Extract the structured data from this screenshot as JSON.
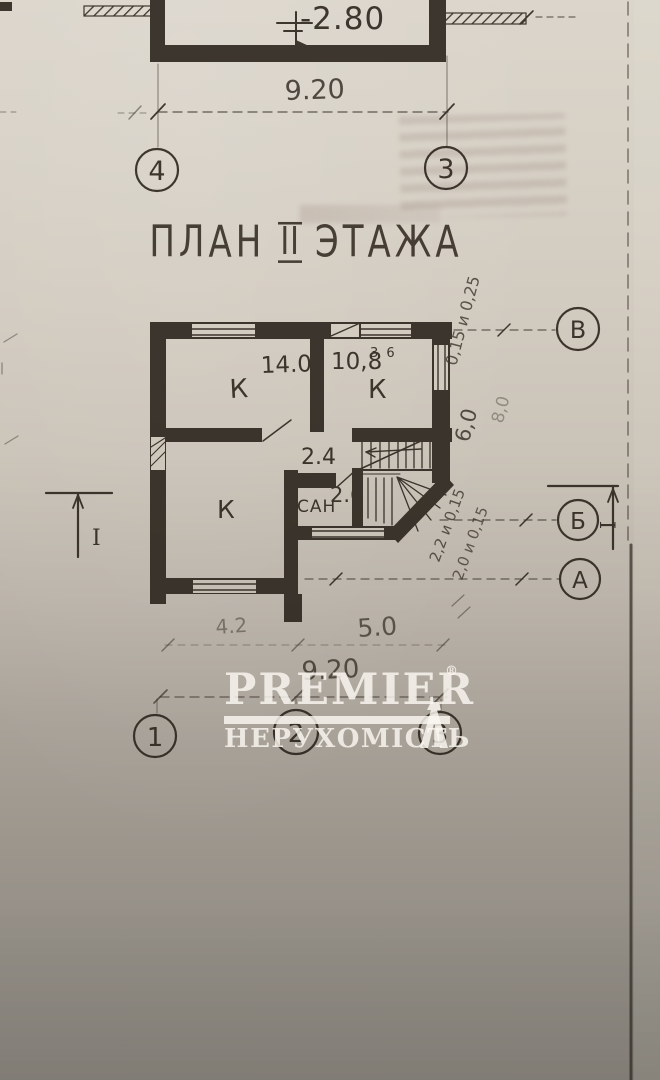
{
  "colors": {
    "ink": "#2b241c",
    "watermark_white": "#fbf8f2"
  },
  "title": {
    "word1": "ПЛАН",
    "numeral": "II",
    "word2": "ЭТАЖА"
  },
  "upper_plan": {
    "level_mark": "-2.80",
    "width_dim": "9.20",
    "axis_left": "4",
    "axis_right": "3"
  },
  "plan": {
    "room_tl_label": "К",
    "room_tl_area": "14.0",
    "room_tr_label": "К",
    "room_tr_area": "10,8",
    "room_tr_area_sup": "3 6",
    "room_bl_label": "К",
    "hall_area": "2.4",
    "san_label": "САН",
    "san_area": "2.6"
  },
  "dims_bottom": {
    "left": "4.2",
    "right": "5.0",
    "total": "9.20"
  },
  "side_notes": {
    "n1": "0,15 и 0,25",
    "n2": "6,0",
    "n3": "8,0",
    "n4": "2,2 и 0,15",
    "n5": "2,0 и 0,15"
  },
  "axes_bottom": {
    "a1": "1",
    "a2": "2",
    "a3": "3"
  },
  "axes_right": {
    "v": "В",
    "b": "Б",
    "a": "А"
  },
  "section": {
    "left": "I",
    "right": "I"
  },
  "watermark": {
    "brand": "PREMIER",
    "registered": "®",
    "subtitle": "НЕРУХОМІСТЬ"
  }
}
